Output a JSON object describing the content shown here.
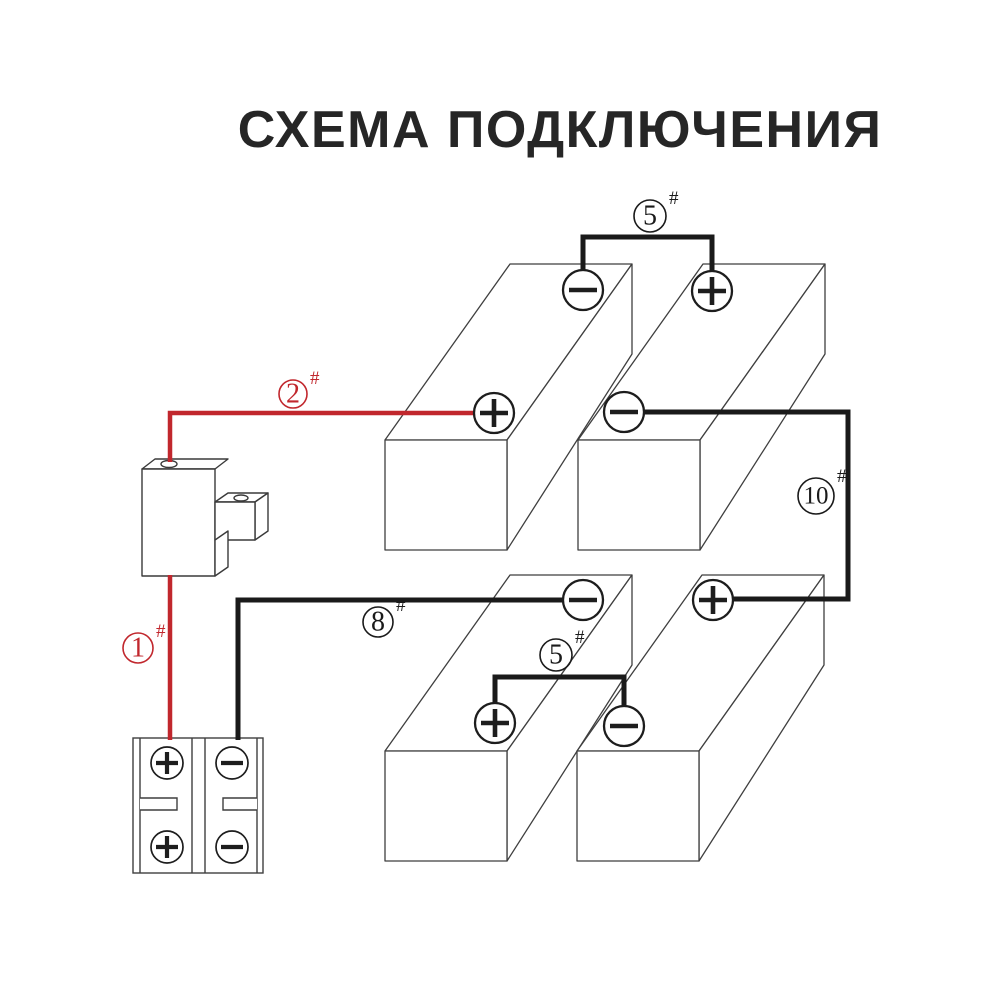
{
  "title": "СХЕМА ПОДКЛЮЧЕНИЯ",
  "colors": {
    "red_wire": "#c1272d",
    "black_wire": "#1a1a1a",
    "outline": "#3f3f3f",
    "terminal_stroke": "#1d1d1d",
    "label_black": "#1a1a1a",
    "background": "#ffffff"
  },
  "box_shape": {
    "w": 122,
    "h": 110,
    "dx": 125,
    "dy": -176,
    "cap_h": 90
  },
  "battery_terminal_radius": 20,
  "batteries": [
    {
      "name": "battery-top-left",
      "origin": [
        385,
        440
      ],
      "terminals": [
        {
          "sign": "−",
          "x": 583,
          "y": 290
        },
        {
          "sign": "+",
          "x": 494,
          "y": 413
        }
      ]
    },
    {
      "name": "battery-top-right",
      "origin": [
        578,
        440
      ],
      "terminals": [
        {
          "sign": "+",
          "x": 712,
          "y": 291
        },
        {
          "sign": "−",
          "x": 624,
          "y": 412
        }
      ]
    },
    {
      "name": "battery-bottom-left",
      "origin": [
        385,
        751
      ],
      "terminals": [
        {
          "sign": "−",
          "x": 583,
          "y": 600
        },
        {
          "sign": "+",
          "x": 495,
          "y": 723
        }
      ]
    },
    {
      "name": "battery-bottom-right",
      "origin": [
        577,
        751
      ],
      "terminals": [
        {
          "sign": "+",
          "x": 713,
          "y": 600
        },
        {
          "sign": "−",
          "x": 624,
          "y": 726
        }
      ]
    }
  ],
  "wires": [
    {
      "label": "5",
      "color": "black",
      "width": 5,
      "points": [
        [
          583,
          270
        ],
        [
          583,
          237
        ],
        [
          712,
          237
        ],
        [
          712,
          271
        ]
      ]
    },
    {
      "label": "2",
      "color": "red",
      "width": 4.5,
      "points": [
        [
          474,
          413
        ],
        [
          170,
          413
        ],
        [
          170,
          462
        ]
      ]
    },
    {
      "label": "1",
      "color": "red",
      "width": 4.5,
      "points": [
        [
          170,
          575
        ],
        [
          170,
          740
        ]
      ]
    },
    {
      "label": "8",
      "color": "black",
      "width": 5,
      "points": [
        [
          238,
          740
        ],
        [
          238,
          600
        ],
        [
          563,
          600
        ]
      ]
    },
    {
      "label": "5",
      "color": "black",
      "width": 5,
      "points": [
        [
          495,
          703
        ],
        [
          495,
          677
        ],
        [
          624,
          677
        ],
        [
          624,
          706
        ]
      ]
    },
    {
      "label": "10",
      "color": "black",
      "width": 5,
      "points": [
        [
          644,
          412
        ],
        [
          848,
          412
        ],
        [
          848,
          599
        ],
        [
          733,
          599
        ]
      ]
    }
  ],
  "labels": [
    {
      "number": "5",
      "suffix": "#",
      "color": "black",
      "x": 650,
      "y": 216,
      "r": 16
    },
    {
      "number": "2",
      "suffix": "#",
      "color": "red",
      "x": 293,
      "y": 394,
      "r": 14
    },
    {
      "number": "1",
      "suffix": "#",
      "color": "red",
      "x": 138,
      "y": 648,
      "r": 15
    },
    {
      "number": "8",
      "suffix": "#",
      "color": "black",
      "x": 378,
      "y": 622,
      "r": 15
    },
    {
      "number": "5",
      "suffix": "#",
      "color": "black",
      "x": 556,
      "y": 655,
      "r": 16
    },
    {
      "number": "10",
      "suffix": "#",
      "color": "black",
      "x": 816,
      "y": 496,
      "r": 18
    }
  ],
  "terminal_block": {
    "screw_radius": 16,
    "screws": [
      {
        "sign": "+",
        "x": 167,
        "y": 763
      },
      {
        "sign": "−",
        "x": 232,
        "y": 763
      },
      {
        "sign": "+",
        "x": 167,
        "y": 847
      },
      {
        "sign": "−",
        "x": 232,
        "y": 847
      }
    ]
  }
}
